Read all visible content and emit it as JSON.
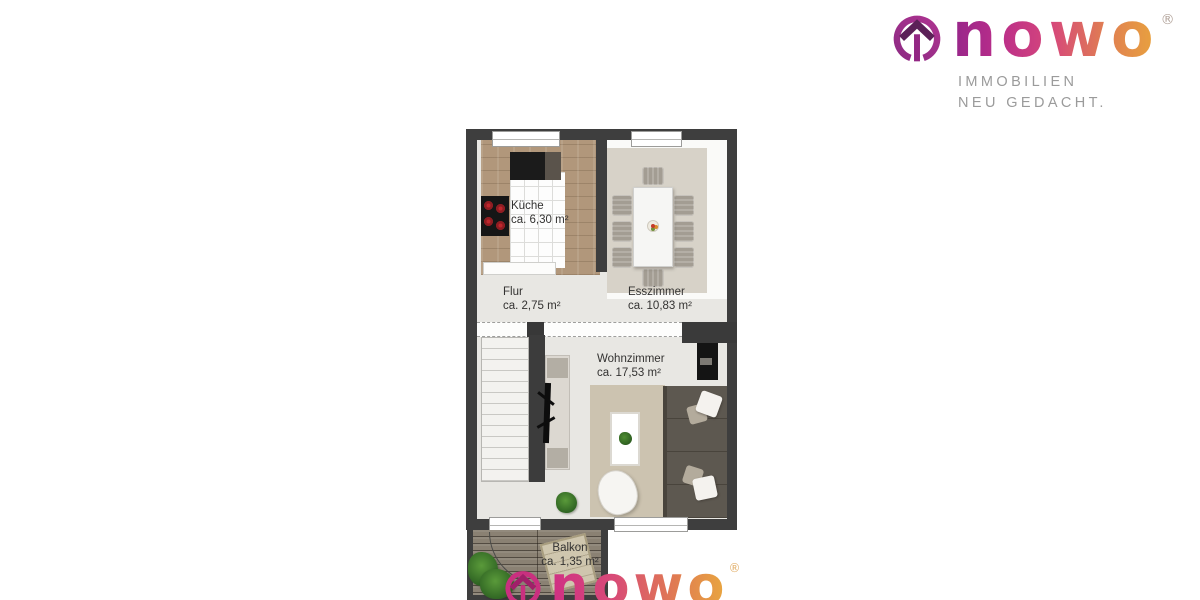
{
  "brand": {
    "wordmark": "nowo",
    "registered": "®",
    "tagline_line1": "IMMOBILIEN",
    "tagline_line2": "NEU GEDACHT."
  },
  "floorplan": {
    "rooms": [
      {
        "name": "Küche",
        "area": "ca. 6,30 m²"
      },
      {
        "name": "Flur",
        "area": "ca. 2,75 m²"
      },
      {
        "name": "Esszimmer",
        "area": "ca. 10,83 m²"
      },
      {
        "name": "Wohnzimmer",
        "area": "ca. 17,53 m²"
      },
      {
        "name": "Balkon",
        "area": "ca. 1,35 m²"
      }
    ]
  },
  "watermark": {
    "wordmark": "nowo",
    "registered": "®"
  },
  "colors": {
    "wall": "#3e3e3e",
    "floor": "#e8e7e3",
    "brand_magenta": "#96268a",
    "brand_pink": "#d6477b",
    "brand_orange": "#e9a53c",
    "tagline_gray": "#9b9b9b"
  }
}
